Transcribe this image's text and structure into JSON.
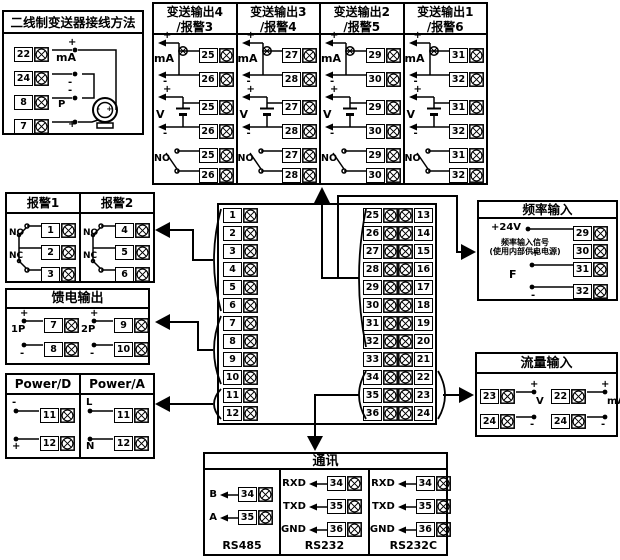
{
  "two_wire": {
    "title": "二线制变送器接线方法",
    "terminals": [
      "22",
      "24",
      "8",
      "7"
    ],
    "labels": {
      "t22": "+",
      "ma": "mA",
      "t24": "-",
      "t8": "-",
      "p": "P",
      "t7": "+"
    },
    "transmitter_marks": "- +"
  },
  "transmit": {
    "section_labels": {
      "ma": "mA",
      "v": "V",
      "no": "NO",
      "plus": "+",
      "minus": "-"
    },
    "panels": [
      {
        "title1": "变送输出4",
        "title2": "/报警3",
        "top": "25",
        "bottom": "26"
      },
      {
        "title1": "变送输出3",
        "title2": "/报警4",
        "top": "27",
        "bottom": "28"
      },
      {
        "title1": "变送输出2",
        "title2": "/报警5",
        "top": "29",
        "bottom": "30"
      },
      {
        "title1": "变送输出1",
        "title2": "/报警6",
        "top": "31",
        "bottom": "32"
      }
    ]
  },
  "alarms": {
    "no": "NO",
    "nc": "NC",
    "columns": [
      {
        "title": "报警1",
        "terminals": [
          "1",
          "2",
          "3"
        ]
      },
      {
        "title": "报警2",
        "terminals": [
          "4",
          "5",
          "6"
        ]
      }
    ]
  },
  "feed": {
    "title": "馈电输出",
    "plus": "+",
    "minus": "-",
    "groups": [
      {
        "label": "1P",
        "top": "7",
        "bottom": "8"
      },
      {
        "label": "2P",
        "top": "9",
        "bottom": "10"
      }
    ]
  },
  "power": {
    "columns": [
      {
        "title": "Power/D",
        "rows": [
          {
            "label": "-",
            "terminal": "11"
          },
          {
            "label": "+",
            "terminal": "12"
          }
        ]
      },
      {
        "title": "Power/A",
        "rows": [
          {
            "label": "L",
            "terminal": "11"
          },
          {
            "label": "N",
            "terminal": "12"
          }
        ]
      }
    ]
  },
  "center": {
    "left": [
      "1",
      "2",
      "3",
      "4",
      "5",
      "6",
      "7",
      "8",
      "9",
      "10",
      "11",
      "12"
    ],
    "middle": [
      "25",
      "26",
      "27",
      "28",
      "29",
      "30",
      "31",
      "32",
      "33",
      "34",
      "35",
      "36"
    ],
    "right": [
      "13",
      "14",
      "15",
      "16",
      "17",
      "18",
      "19",
      "20",
      "21",
      "22",
      "23",
      "24"
    ]
  },
  "frequency": {
    "title": "频率输入",
    "row1_label": "+24V",
    "row1_terminal": "29",
    "row2_label1": "频率输入信号",
    "row2_label2": "(使用内部供电电源)",
    "row2_terminal": "30",
    "row3_label": "+",
    "row3_terminal": "31",
    "f_label": "F",
    "row4_label": "-",
    "row4_terminal": "32"
  },
  "flow": {
    "title": "流量输入",
    "plus": "+",
    "minus": "-",
    "groups": [
      {
        "top": "23",
        "bottom": "24",
        "unit": "V"
      },
      {
        "top": "22",
        "bottom": "24",
        "unit": "mA"
      }
    ]
  },
  "comm": {
    "title": "通讯",
    "ports": [
      {
        "name": "RS485",
        "rows": [
          {
            "label": "B",
            "terminal": "34"
          },
          {
            "label": "A",
            "terminal": "35"
          }
        ]
      },
      {
        "name": "RS232",
        "rows": [
          {
            "label": "RXD",
            "terminal": "34"
          },
          {
            "label": "TXD",
            "terminal": "35"
          },
          {
            "label": "GND",
            "terminal": "36"
          }
        ]
      },
      {
        "name": "RS232C",
        "rows": [
          {
            "label": "RXD",
            "terminal": "34"
          },
          {
            "label": "TXD",
            "terminal": "35"
          },
          {
            "label": "GND",
            "terminal": "36"
          }
        ]
      }
    ]
  },
  "colors": {
    "line": "#000000",
    "bg": "#ffffff"
  }
}
